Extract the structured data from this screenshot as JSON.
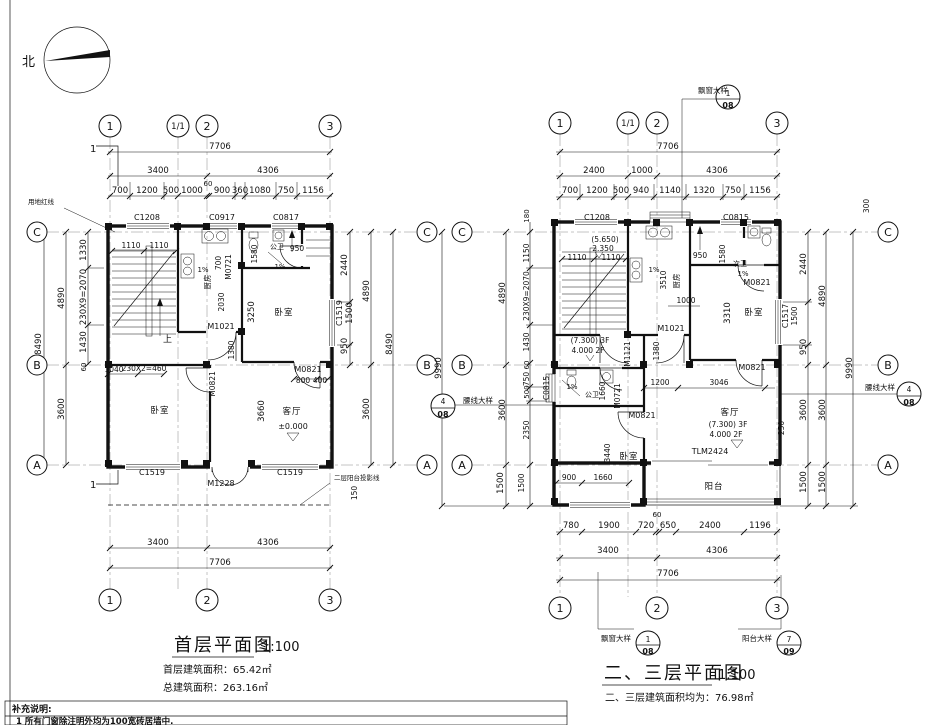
{
  "north": "北",
  "notes": {
    "title": "补充说明:",
    "item1": "1    所有门窗除注明外均为100宽砖居墙中."
  },
  "p1": {
    "name": "首层平面图",
    "scale": "1:100",
    "area1": "首层建筑面积：65.42㎡",
    "area2": "总建筑面积：263.16㎡",
    "grid": {
      "g1": "1",
      "g11": "1/1",
      "g2": "2",
      "g3": "3",
      "gc": "C",
      "gb": "B",
      "ga": "A"
    },
    "dims": {
      "w_total": "7706",
      "w1": "3400",
      "w2": "4306",
      "wd": [
        "700",
        "1200",
        "500",
        "1000",
        "60",
        "900",
        "360",
        "1080",
        "750",
        "1156"
      ],
      "h_total": "8490",
      "h1": "4890",
      "h2": "3600",
      "hd": [
        "1330",
        "230X9=2070",
        "1430",
        "60"
      ],
      "rd": [
        "2440",
        "1500",
        "950"
      ],
      "rw": "C1519",
      "b1": "3400",
      "b2": "4306",
      "b_total": "7706",
      "proj": "150"
    },
    "win": {
      "t1": "C1208",
      "t2": "C0917",
      "t3": "C0817",
      "b1": "C1519",
      "b2": "C1519"
    },
    "door": {
      "entry": "M1228",
      "k": "M0721",
      "h": "M1021",
      "b1": "M0821",
      "b2": "M0821",
      "pos800": "800",
      "pos400": "400"
    },
    "room": {
      "kitchen": "厨房",
      "bath": "公卫",
      "bed1": "卧室",
      "bed2": "卧室",
      "living": "客厅"
    },
    "stair": {
      "up": "上",
      "d1": "1110",
      "d2": "1110"
    },
    "lvl": {
      "zero": "±0.000"
    },
    "idim": {
      "i2030": "2030",
      "i700": "700",
      "i1580": "1580",
      "i950": "950",
      "i1380": "1380",
      "i3250": "3250",
      "i3660": "3660",
      "i1040": "1040",
      "i230": "230X2=460",
      "slope1": "1%",
      "slope2": "1%"
    },
    "anno": {
      "redline": "用地红线",
      "proj_label": "二层阳台投影线",
      "sec": "1"
    }
  },
  "p2": {
    "name": "二、三层平面图",
    "scale": "1:100",
    "area1": "二、三层建筑面积均为：76.98㎡",
    "grid": {
      "g1": "1",
      "g11": "1/1",
      "g2": "2",
      "g3": "3",
      "gc": "C",
      "gb": "B",
      "ga": "A"
    },
    "dims": {
      "w_total": "7706",
      "w1": "2400",
      "w2": "1000",
      "w3": "4306",
      "wd": [
        "700",
        "1200",
        "500",
        "940",
        "1140",
        "1320",
        "750",
        "1156"
      ],
      "h_total": "9990",
      "h1": "4890",
      "h2": "3600",
      "h3": "1500",
      "hd": [
        "180",
        "1150",
        "230X9=2070",
        "1430",
        "60",
        "750",
        "500",
        "2350",
        "1500"
      ],
      "rd": [
        "300",
        "2440",
        "950"
      ],
      "rw": "C1517",
      "rw2": "1500",
      "lw": "C0815",
      "bd": [
        "780",
        "1900",
        "720",
        "650",
        "2400",
        "1196"
      ],
      "b60": "60",
      "b1": "3400",
      "b2": "4306",
      "b_total": "7706"
    },
    "win": {
      "t1": "C1208",
      "t2": "C0815"
    },
    "door": {
      "k": "M1021",
      "s": "M1121",
      "bath": "M0721",
      "bed1": "M0821",
      "bed2": "M0821",
      "liv": "M0821",
      "balc": "TLM2424"
    },
    "room": {
      "kitchen": "厨房",
      "bath2": "次卫",
      "bath": "公卫",
      "bed1": "卧室",
      "bed2": "卧室",
      "living": "客厅",
      "balcony": "阳台"
    },
    "stair": {
      "d1": "1110",
      "d2": "1110"
    },
    "lvl": {
      "top": "(5.650)",
      "mid": "2.350",
      "s3f": "(7.300) 3F",
      "s2f": "4.000 2F",
      "l3f": "(7.300) 3F",
      "l2f": "4.000 2F"
    },
    "idim": {
      "i3510": "3510",
      "i1000": "1000",
      "i950": "950",
      "i1580": "1580",
      "i3310": "3310",
      "i1380": "1380",
      "i1660": "1660",
      "i1200": "1200",
      "i3046": "3046",
      "i250": "250",
      "i3440": "3440",
      "i900": "900",
      "i1660b": "1660",
      "slope1": "1%",
      "slope2": "1%",
      "slope3": "1%"
    },
    "callout": {
      "baywin": "飘窗大样",
      "balcony": "阳台大样",
      "waist": "腰线大样",
      "n1": "1",
      "d08": "08",
      "n7": "7",
      "d09": "09",
      "n4": "4"
    }
  }
}
